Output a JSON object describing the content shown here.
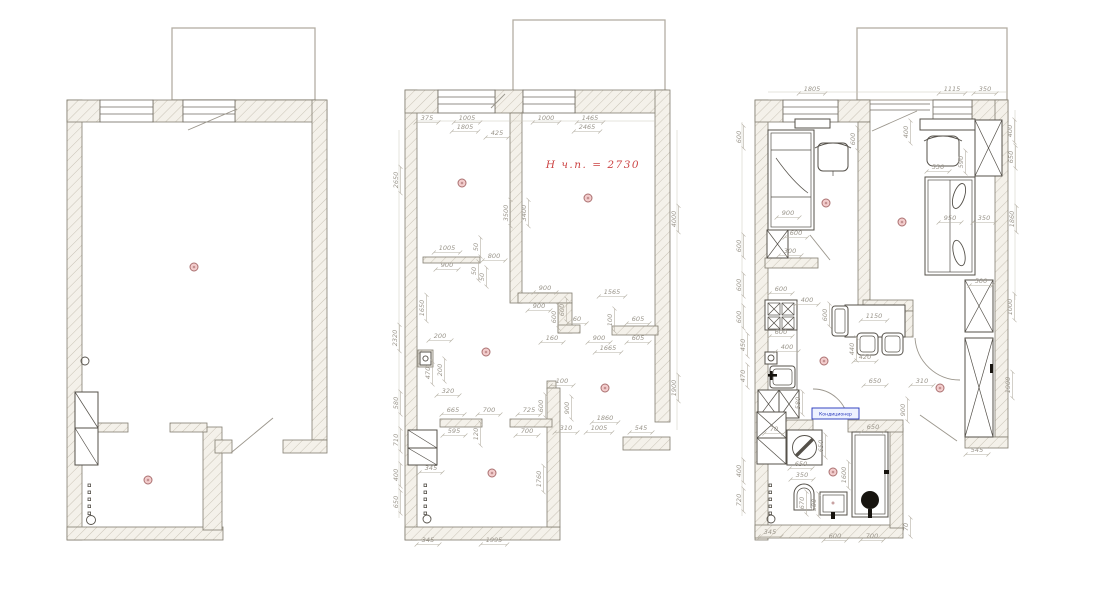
{
  "meta": {
    "background": "#ffffff",
    "wall_fill": "#f4f1ea",
    "wall_stroke": "#837e70",
    "dim_color": "#9b968c",
    "furniture_color": "#55514a",
    "balcony_color": "#b3aea3",
    "marker_fill": "#f3cdcd",
    "marker_stroke": "#aa7070",
    "note_red": "#cc4444",
    "label_blue": "#2233bb"
  },
  "annotations": {
    "ceiling_height": "Н ч.п. = 2730",
    "ac_label": "Кондиционер"
  },
  "plans": [
    {
      "name": "existing-plan",
      "dims": [],
      "markers": [
        [
          194,
          267
        ],
        [
          148,
          480
        ]
      ]
    },
    {
      "name": "measured-plan",
      "dims": [
        [
          "375",
          427,
          121
        ],
        [
          "1005",
          467,
          121
        ],
        [
          "1805",
          465,
          130
        ],
        [
          "425",
          497,
          136
        ],
        [
          "1000",
          546,
          121
        ],
        [
          "1465",
          590,
          121
        ],
        [
          "2465",
          587,
          130
        ],
        [
          "2650",
          399,
          180,
          1
        ],
        [
          "3500",
          509,
          213,
          1
        ],
        [
          "3400",
          527,
          213,
          1
        ],
        [
          "4000",
          677,
          219,
          1
        ],
        [
          "1005",
          447,
          251
        ],
        [
          "50",
          479,
          247,
          1
        ],
        [
          "800",
          494,
          259
        ],
        [
          "900",
          447,
          268
        ],
        [
          "50",
          477,
          271,
          1
        ],
        [
          "50",
          485,
          277,
          1
        ],
        [
          "1650",
          425,
          308,
          1
        ],
        [
          "2320",
          398,
          338,
          1
        ],
        [
          "200",
          440,
          339
        ],
        [
          "470",
          431,
          373,
          1
        ],
        [
          "200",
          443,
          370,
          1
        ],
        [
          "320",
          448,
          394
        ],
        [
          "580",
          399,
          403,
          1
        ],
        [
          "900",
          545,
          291
        ],
        [
          "1565",
          612,
          295
        ],
        [
          "900",
          539,
          309
        ],
        [
          "600",
          557,
          317,
          1
        ],
        [
          "600",
          565,
          310,
          1
        ],
        [
          "60",
          577,
          322
        ],
        [
          "100",
          613,
          320,
          1
        ],
        [
          "605",
          638,
          322
        ],
        [
          "160",
          552,
          341
        ],
        [
          "900",
          599,
          341
        ],
        [
          "605",
          638,
          341
        ],
        [
          "1665",
          608,
          351
        ],
        [
          "665",
          453,
          413
        ],
        [
          "700",
          489,
          413
        ],
        [
          "725",
          529,
          413
        ],
        [
          "595",
          454,
          434
        ],
        [
          "120",
          479,
          434,
          1
        ],
        [
          "700",
          527,
          434
        ],
        [
          "100",
          562,
          384
        ],
        [
          "600",
          544,
          406,
          1
        ],
        [
          "900",
          570,
          408,
          1
        ],
        [
          "310",
          566,
          431
        ],
        [
          "1005",
          599,
          431
        ],
        [
          "545",
          641,
          431
        ],
        [
          "1860",
          605,
          421
        ],
        [
          "1900",
          677,
          388,
          1
        ],
        [
          "710",
          399,
          440,
          1
        ],
        [
          "400",
          399,
          475,
          1
        ],
        [
          "650",
          399,
          502,
          1
        ],
        [
          "345",
          431,
          471
        ],
        [
          "1760",
          542,
          479,
          1
        ],
        [
          "345",
          428,
          543
        ],
        [
          "1995",
          494,
          543
        ]
      ],
      "markers": [
        [
          462,
          183
        ],
        [
          588,
          198
        ],
        [
          486,
          352
        ],
        [
          605,
          388
        ],
        [
          492,
          473
        ]
      ]
    },
    {
      "name": "furnished-plan",
      "dims": [
        [
          "1805",
          812,
          92
        ],
        [
          "1115",
          952,
          92
        ],
        [
          "350",
          985,
          92
        ],
        [
          "600",
          742,
          137,
          1
        ],
        [
          "600",
          856,
          139,
          1
        ],
        [
          "400",
          909,
          132,
          1
        ],
        [
          "400",
          1013,
          131,
          1
        ],
        [
          "650",
          1014,
          157,
          1
        ],
        [
          "590",
          964,
          162,
          1
        ],
        [
          "530",
          938,
          170
        ],
        [
          "900",
          788,
          216
        ],
        [
          "950",
          950,
          221
        ],
        [
          "350",
          984,
          221
        ],
        [
          "1860",
          1015,
          219,
          1
        ],
        [
          "600",
          796,
          236
        ],
        [
          "300",
          790,
          254
        ],
        [
          "600",
          742,
          246,
          1
        ],
        [
          "600",
          742,
          285,
          1
        ],
        [
          "600",
          781,
          292
        ],
        [
          "400",
          807,
          303
        ],
        [
          "600",
          781,
          335
        ],
        [
          "400",
          787,
          350
        ],
        [
          "450",
          746,
          345,
          1
        ],
        [
          "470",
          746,
          376,
          1
        ],
        [
          "600",
          742,
          317,
          1
        ],
        [
          "600",
          828,
          315,
          1
        ],
        [
          "1150",
          874,
          319
        ],
        [
          "440",
          855,
          349,
          1
        ],
        [
          "420",
          865,
          360
        ],
        [
          "580",
          801,
          403,
          1
        ],
        [
          "650",
          875,
          384
        ],
        [
          "310",
          922,
          384
        ],
        [
          "900",
          906,
          410,
          1
        ],
        [
          "650",
          873,
          430
        ],
        [
          "70",
          774,
          432
        ],
        [
          "650",
          824,
          446,
          1
        ],
        [
          "650",
          801,
          467
        ],
        [
          "1600",
          847,
          475,
          1
        ],
        [
          "400",
          742,
          471,
          1
        ],
        [
          "350",
          802,
          478
        ],
        [
          "720",
          742,
          500,
          1
        ],
        [
          "670",
          805,
          503,
          1
        ],
        [
          "500",
          817,
          505,
          1
        ],
        [
          "345",
          770,
          535
        ],
        [
          "600",
          835,
          539
        ],
        [
          "700",
          872,
          539
        ],
        [
          "70",
          909,
          527,
          1
        ],
        [
          "500",
          981,
          284
        ],
        [
          "1000",
          1013,
          307,
          1
        ],
        [
          "1900",
          1011,
          385,
          1
        ],
        [
          "545",
          977,
          453
        ]
      ],
      "markers": [
        [
          826,
          203
        ],
        [
          902,
          222
        ],
        [
          824,
          361
        ],
        [
          833,
          472
        ],
        [
          940,
          388
        ]
      ]
    }
  ]
}
